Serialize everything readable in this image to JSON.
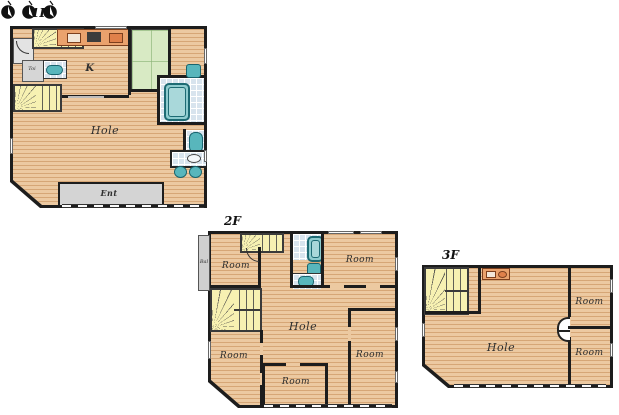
{
  "colors": {
    "wood": "#ecc9a1",
    "wall": "#1d1d1d",
    "tatami": "#d8eac4",
    "stairs": "#f7f1b2",
    "tile": "#d8e4ee",
    "fixture": "#58b6bc",
    "counter": "#eaa26d",
    "gray": "#d4d4d4"
  },
  "floors": [
    {
      "name": "first-floor",
      "label": "1F",
      "labels": {
        "kitchen": "K",
        "hole": "Hole",
        "entrance": "Ent",
        "toilet": "Toi"
      }
    },
    {
      "name": "second-floor",
      "label": "2F",
      "labels": {
        "balcony": "Bal",
        "hole": "Hole",
        "room_top_left": "Room",
        "room_top_right": "Room",
        "room_bottom_left": "Room",
        "room_bottom_center": "Room",
        "room_bottom_right": "Room"
      }
    },
    {
      "name": "third-floor",
      "label": "3F",
      "labels": {
        "hole": "Hole",
        "room_top_right": "Room",
        "room_bottom_right": "Room"
      }
    }
  ]
}
